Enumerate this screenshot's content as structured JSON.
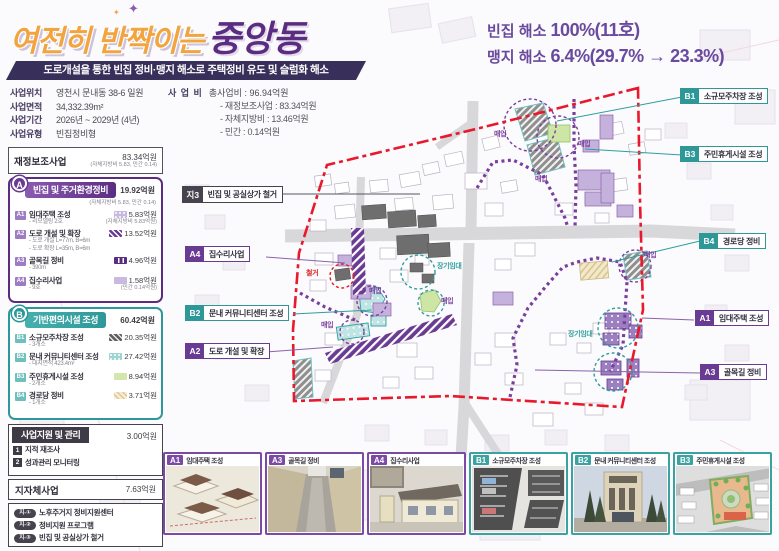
{
  "colors": {
    "purple": "#5b2d82",
    "purple_mid": "#7a3f9d",
    "lavender": "#c9b8e0",
    "teal": "#2e9898",
    "red": "#e8192c",
    "orange": "#f2a53f",
    "dark": "#3f3b46"
  },
  "header": {
    "title_script": "여전히 반짝이는",
    "title_main": "중앙동",
    "sparkle": "✦",
    "subtitle": "도로개설을 통한 빈집 정비·맹지 해소로 주택정비 유도 및 슬럼화 해소",
    "info": [
      {
        "label": "사업위치",
        "value": "영천시 문내동 38-6 일원"
      },
      {
        "label": "사업면적",
        "value": "34,332.39m²"
      },
      {
        "label": "사업기간",
        "value": "2026년 ~ 2029년 (4년)"
      },
      {
        "label": "사업유형",
        "value": "빈집정비형"
      }
    ],
    "budget": {
      "label": "사 업 비",
      "total": "총사업비 : 96.94억원",
      "items": [
        "- 재정보조사업 : 83.34억원",
        "- 자체지방비 : 13.46억원",
        "- 민간 : 0.14억원"
      ]
    },
    "stats": [
      {
        "label": "빈집 해소 ",
        "value": "100%(11호)"
      },
      {
        "label": "맹지 해소 ",
        "value": "6.4%(29.7% → 23.3%)"
      }
    ]
  },
  "sidebar": {
    "subsidy": {
      "title": "재정보조사업",
      "amount": "83.34억원",
      "note": "(자체지방비 5.83, 민간 0.14)"
    },
    "section_a": {
      "badge": "A",
      "title": "빈집 및 주거환경정비",
      "amount": "19.92억원",
      "note": "(자체지방비 5.83, 민간 0.14)",
      "items": [
        {
          "badge": "A1",
          "title": "임대주택 조성",
          "subs": [
            "- 리모델링 2호"
          ],
          "amount": "5.83억원",
          "amount_note": "(자체지방비 5.83억원)"
        },
        {
          "badge": "A2",
          "title": "도로 개설 및 확장",
          "subs": [
            "- 도로 개설 L=77m, B=6m",
            "- 도로 확장 L=35m, B=6m"
          ],
          "amount": "13.52억원",
          "amount_note": ""
        },
        {
          "badge": "A3",
          "title": "골목길 정비",
          "subs": [
            "- 390m"
          ],
          "amount": "4.96억원",
          "amount_note": ""
        },
        {
          "badge": "A4",
          "title": "집수리사업",
          "subs": [
            "- 9호"
          ],
          "amount": "1.58억원",
          "amount_note": "(민간 0.14억원)"
        }
      ]
    },
    "section_b": {
      "badge": "B",
      "title": "기반편의시설 조성",
      "amount": "60.42억원",
      "items": [
        {
          "badge": "B1",
          "title": "소규모주차장 조성",
          "subs": [
            "- 3개소"
          ],
          "amount": "20.35억원"
        },
        {
          "badge": "B2",
          "title": "문내 커뮤니티센터 조성",
          "subs": [
            "- 대지면적 423.4m²"
          ],
          "amount": "27.42억원"
        },
        {
          "badge": "B3",
          "title": "주민휴게시설 조성",
          "subs": [
            "- 2개소"
          ],
          "amount": "8.94억원"
        },
        {
          "badge": "B4",
          "title": "경로당 정비",
          "subs": [
            "- 1개소"
          ],
          "amount": "3.71억원"
        }
      ]
    },
    "support": {
      "title": "사업지원 및 관리",
      "amount": "3.00억원",
      "items": [
        {
          "badge": "1",
          "label": "지적 재조사"
        },
        {
          "badge": "2",
          "label": "성과관리 모니터링"
        }
      ]
    },
    "municipal": {
      "title": "지자체사업",
      "amount": "7.63억원",
      "items": [
        {
          "badge": "지-①",
          "label": "노후주거지 정비지원센터"
        },
        {
          "badge": "지-②",
          "label": "정비지원 프로그램"
        },
        {
          "badge": "지-③",
          "label": "빈집 및 공실상가 철거"
        }
      ]
    }
  },
  "map": {
    "callouts": {
      "ji3": {
        "badge": "지3",
        "label": "빈집 및 공실상가 철거"
      },
      "a4": {
        "badge": "A4",
        "label": "집수리사업"
      },
      "b2": {
        "badge": "B2",
        "label": "문내 커뮤니티센터 조성"
      },
      "a2": {
        "badge": "A2",
        "label": "도로 개설 및 확장"
      },
      "b1": {
        "badge": "B1",
        "label": "소규모주차장 조성"
      },
      "b3": {
        "badge": "B3",
        "label": "주민휴게시설 조성"
      },
      "b4": {
        "badge": "B4",
        "label": "경로당 정비"
      },
      "a1": {
        "badge": "A1",
        "label": "임대주택 조성"
      },
      "a3": {
        "badge": "A3",
        "label": "골목길 정비"
      }
    },
    "annotations": {
      "demolish": "철거",
      "purchase": "매입",
      "long_lease": "장기임대"
    }
  },
  "cards": [
    {
      "badge": "A1",
      "title": "임대주택 조성"
    },
    {
      "badge": "A3",
      "title": "골목길 정비"
    },
    {
      "badge": "A4",
      "title": "집수리사업"
    },
    {
      "badge": "B1",
      "title": "소규모주차장 조성"
    },
    {
      "badge": "B2",
      "title": "문내 커뮤니티센터 조성"
    },
    {
      "badge": "B3",
      "title": "주민휴게시설 조성"
    }
  ]
}
